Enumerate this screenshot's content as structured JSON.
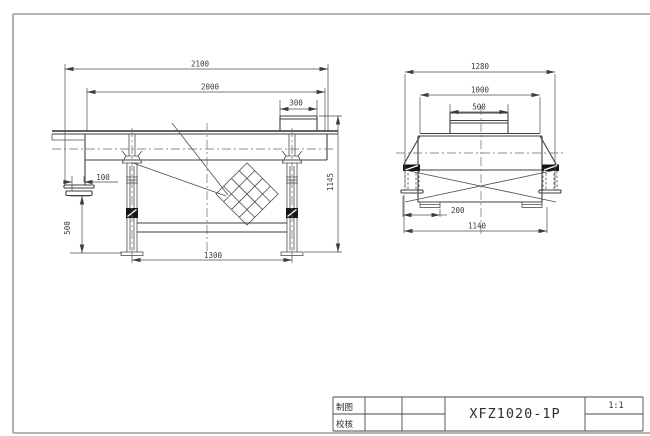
{
  "side_view": {
    "dims": {
      "overall_length": "2100",
      "screen_length": "2000",
      "inlet_length": "300",
      "outlet_offset": "100",
      "outlet_height": "500",
      "overall_height": "1145",
      "leg_spacing": "1300"
    }
  },
  "end_view": {
    "dims": {
      "overall_width": "1280",
      "body_width": "1000",
      "inlet_width": "500",
      "foot_offset": "200",
      "base_width": "1140"
    }
  },
  "title_block": {
    "drawn_label": "制图",
    "checked_label": "校核",
    "model": "XFZ1020-1P",
    "scale": "1:1"
  }
}
